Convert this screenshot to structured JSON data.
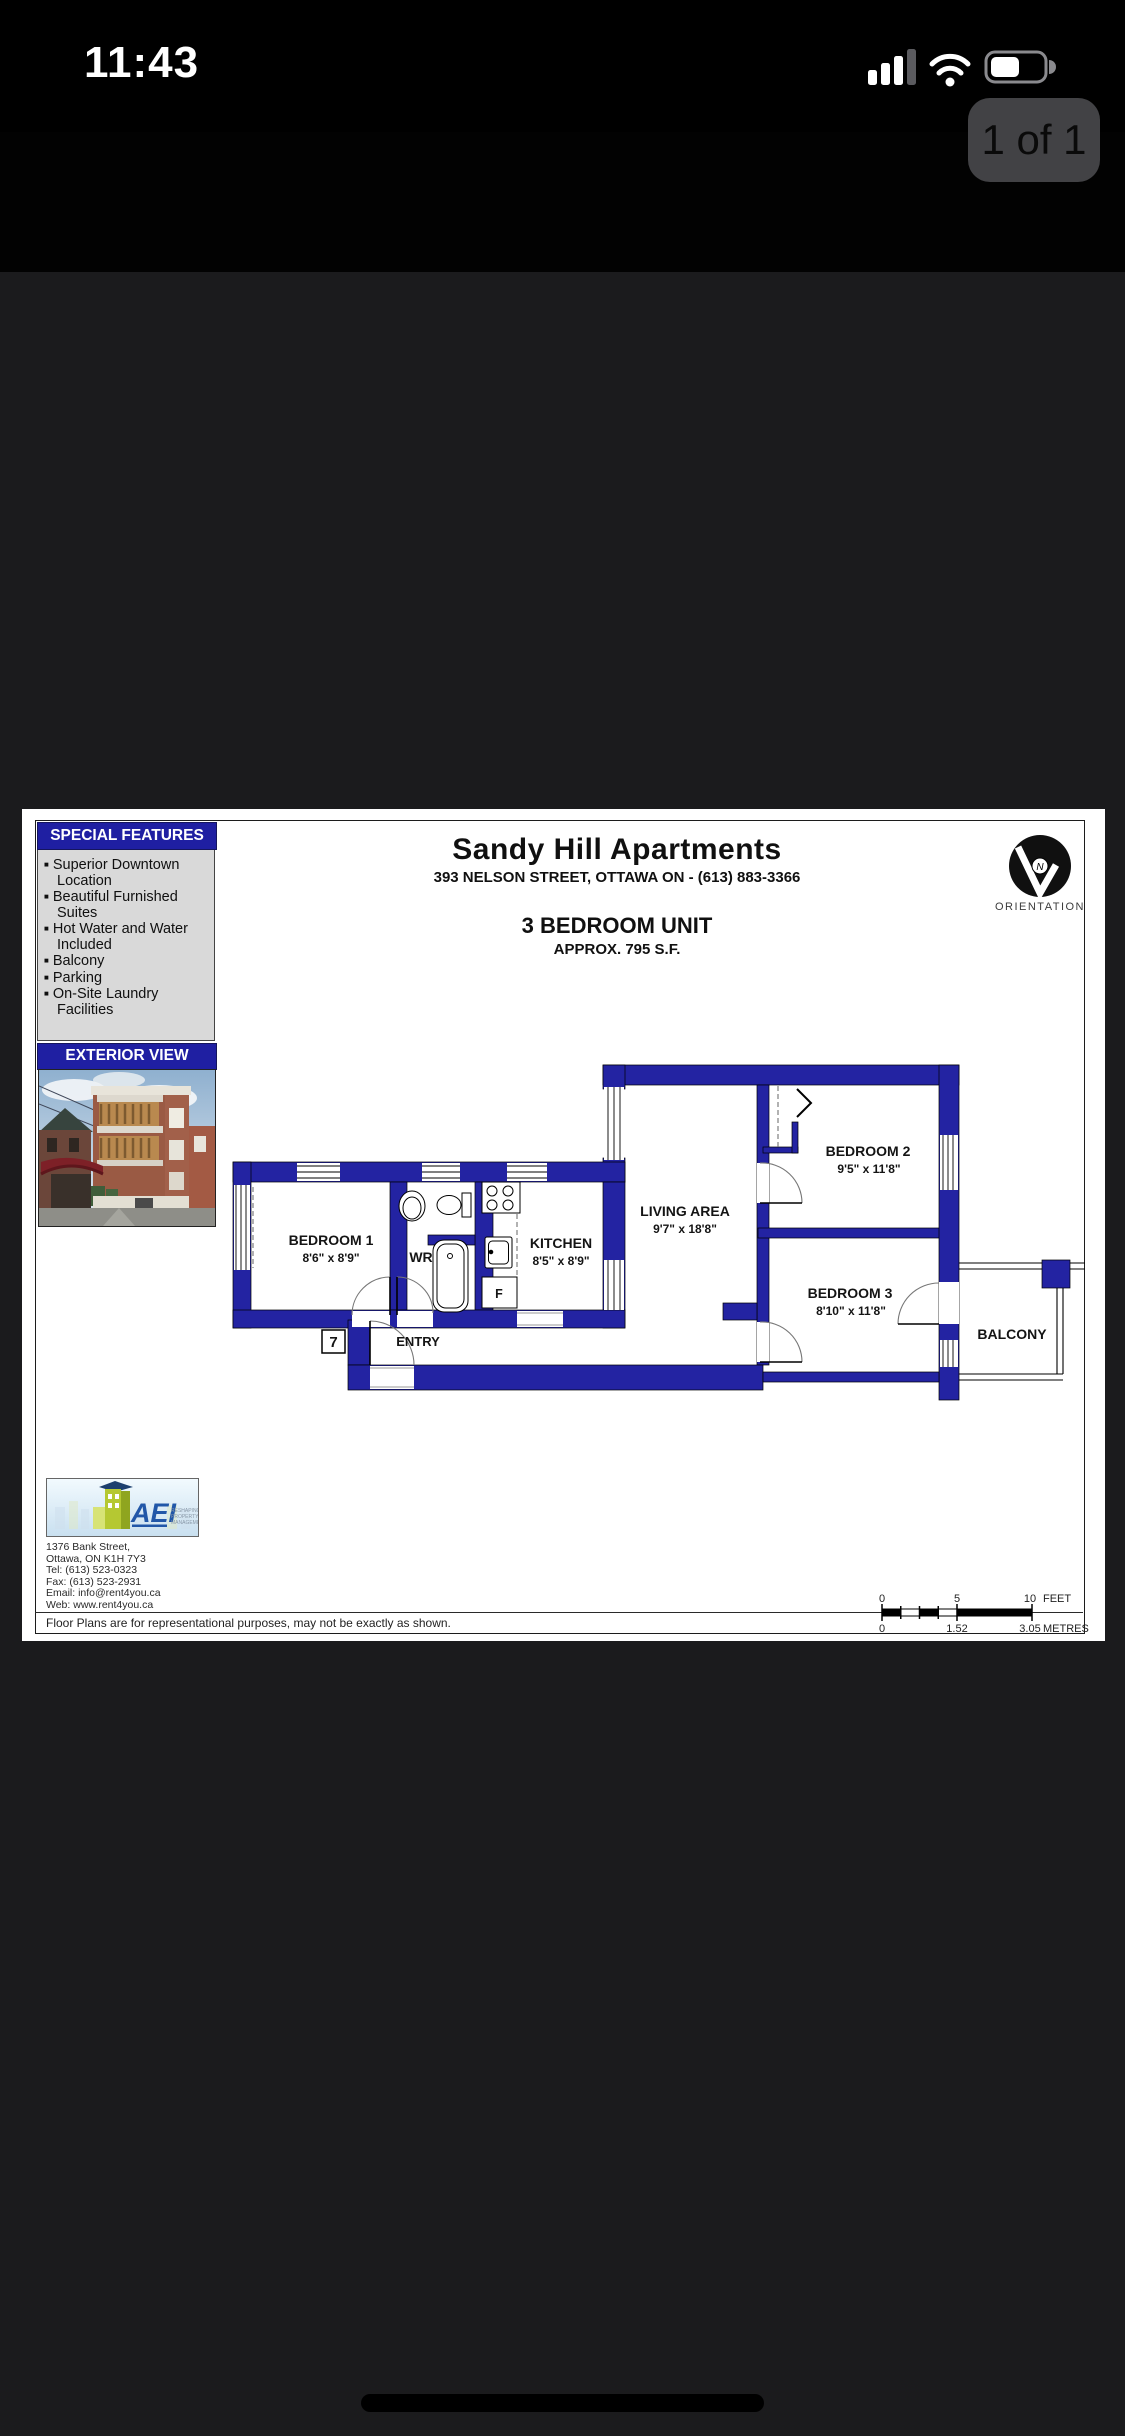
{
  "status_bar": {
    "time": "11:43"
  },
  "page_badge": "1 of 1",
  "nav": {
    "title": "Unit07-AB-Jun04-13…"
  },
  "colors": {
    "wall_blue": "#2323a2",
    "header_blue": "#1f1fa2",
    "viewer_bg": "#1b1b1d",
    "badge_bg": "#424245",
    "logo_blue": "#2157a8",
    "logo_green": "#b5c832",
    "awning_red": "#7d2027"
  },
  "document": {
    "special_features": {
      "header": "SPECIAL FEATURES",
      "items": [
        "Superior Downtown Location",
        "Beautiful Furnished Suites",
        "Hot Water and Water Included",
        "Balcony",
        "Parking",
        "On-Site Laundry Facilities"
      ]
    },
    "exterior": {
      "header": "EXTERIOR VIEW"
    },
    "title_block": {
      "building": "Sandy Hill Apartments",
      "address": "393 NELSON STREET, OTTAWA ON - (613) 883-3366",
      "unit_type": "3 BEDROOM UNIT",
      "area": "APPROX. 795 S.F."
    },
    "orientation": {
      "label": "ORIENTATION",
      "north": "N"
    },
    "floor_plan": {
      "rooms": {
        "bedroom1": {
          "name": "BEDROOM 1",
          "dims": "8'6\" x 8'9\""
        },
        "wr": {
          "name": "WR"
        },
        "kitchen": {
          "name": "KITCHEN",
          "dims": "8'5\" x 8'9\""
        },
        "living": {
          "name": "LIVING AREA",
          "dims": "9'7\" x 18'8\""
        },
        "bedroom2": {
          "name": "BEDROOM 2",
          "dims": "9'5\" x 11'8\""
        },
        "bedroom3": {
          "name": "BEDROOM 3",
          "dims": "8'10\" x 11'8\""
        },
        "balcony": {
          "name": "BALCONY"
        }
      },
      "labels": {
        "entry": "ENTRY",
        "unit_number": "7",
        "fridge": "F"
      }
    },
    "company": {
      "logo_text": "AEI",
      "tagline": [
        "RESHAPING",
        "PROPERTY",
        "MANAGEMENT"
      ],
      "address_lines": [
        "1376 Bank Street,",
        "Ottawa, ON K1H 7Y3",
        "Tel: (613) 523-0323",
        "Fax: (613) 523-2931",
        "Email: info@rent4you.ca",
        "Web: www.rent4you.ca"
      ]
    },
    "disclaimer": "Floor Plans are for representational purposes, may not be exactly as shown.",
    "scale_bar": {
      "feet_ticks": [
        "0",
        "5",
        "10"
      ],
      "feet_unit": "FEET",
      "metre_ticks": [
        "0",
        "1.52",
        "3.05"
      ],
      "metre_unit": "METRES"
    }
  }
}
